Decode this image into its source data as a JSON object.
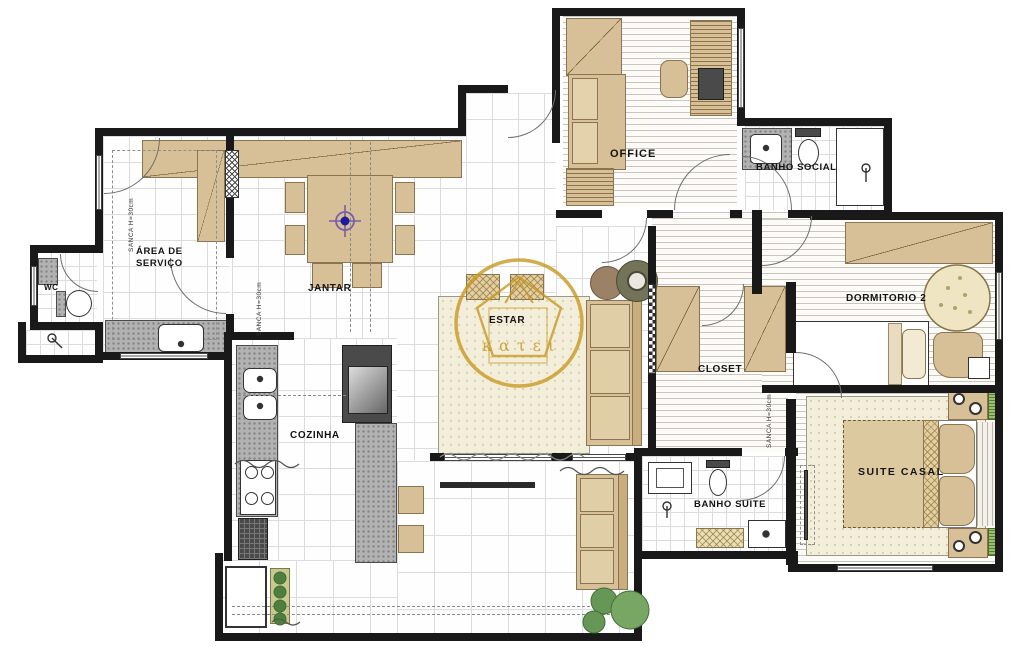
{
  "plan": {
    "watermark": "κατει",
    "labels": {
      "area_servico_1": "ÁREA DE",
      "area_servico_2": "SERVIÇO",
      "wc": "WC",
      "jantar": "JANTAR",
      "cozinha": "COZINHA",
      "estar": "ESTAR",
      "office": "OFFICE",
      "banho_social": "BANHO SOCIAL",
      "dormitorio_2": "DORMITORIO 2",
      "closet": "CLOSET",
      "banho_suite": "BANHO SUITE",
      "suite_casal": "SUITE CASAL"
    },
    "notes": {
      "sanca": "SANCA H=30cm"
    },
    "colors": {
      "wood": "#d7bf97",
      "wall": "#191919",
      "watermark_gold": "#c99822",
      "rug_cream": "#f3eeda",
      "granite_gray": "#b2b2b2",
      "light_point_blue": "#1c1c9c",
      "plant_green": "#6f9f57"
    }
  }
}
